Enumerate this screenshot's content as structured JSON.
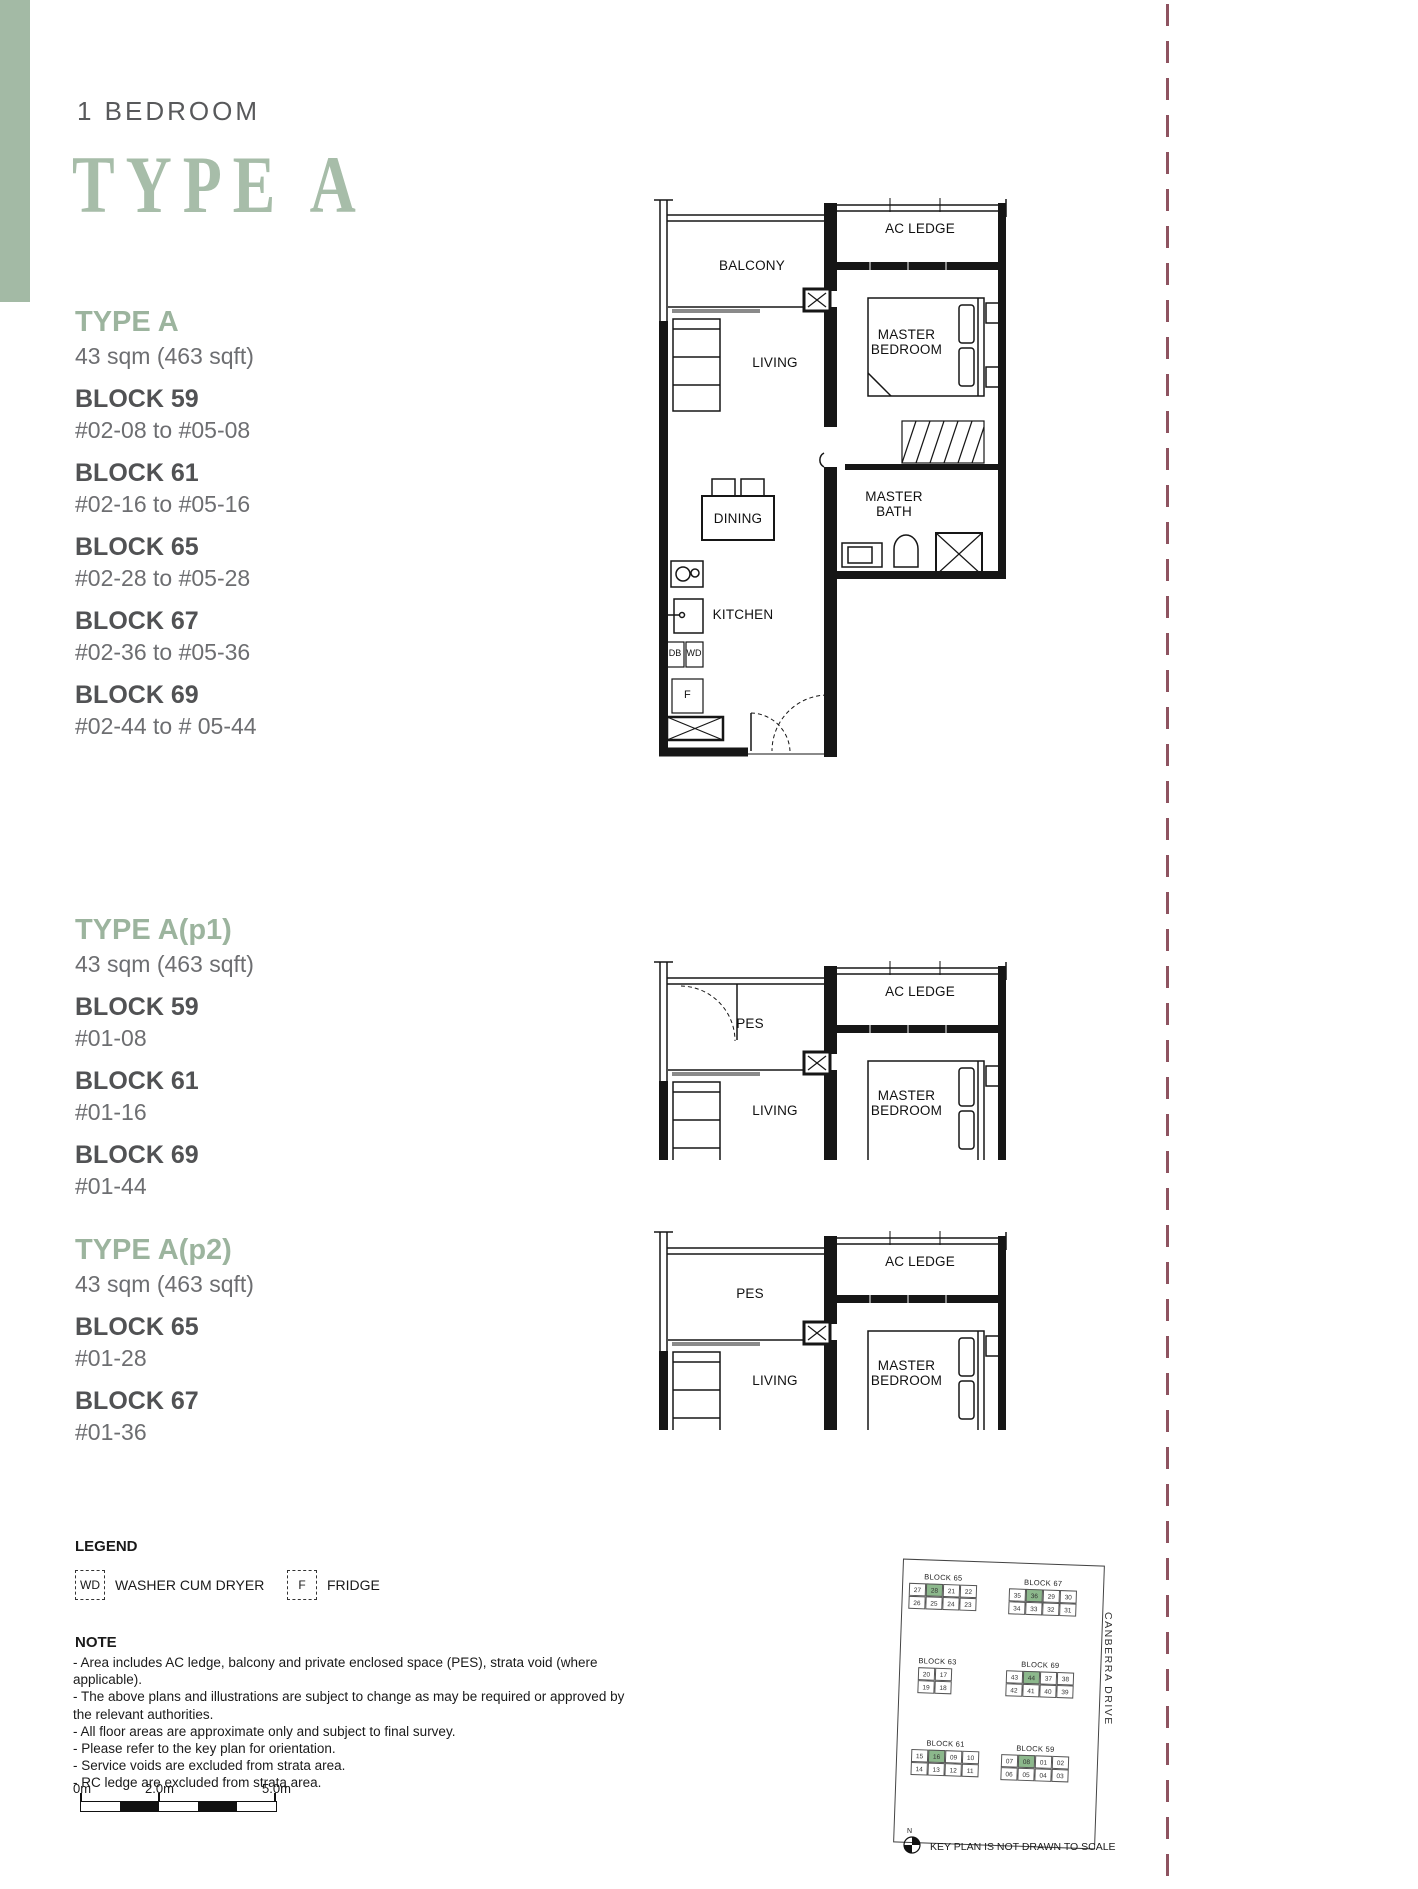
{
  "page": {
    "category": "1 BEDROOM",
    "wordmark": "TYPE A"
  },
  "sections": [
    {
      "title": "TYPE A",
      "area": "43 sqm (463 sqft)",
      "blocks": [
        {
          "name": "BLOCK 59",
          "units": "#02-08 to #05-08"
        },
        {
          "name": "BLOCK 61",
          "units": "#02-16 to #05-16"
        },
        {
          "name": "BLOCK 65",
          "units": "#02-28 to #05-28"
        },
        {
          "name": "BLOCK 67",
          "units": "#02-36 to #05-36"
        },
        {
          "name": "BLOCK 69",
          "units": "#02-44 to # 05-44"
        }
      ]
    },
    {
      "title": "TYPE A(p1)",
      "area": "43 sqm (463 sqft)",
      "blocks": [
        {
          "name": "BLOCK 59",
          "units": "#01-08"
        },
        {
          "name": "BLOCK 61",
          "units": "#01-16"
        },
        {
          "name": "BLOCK 69",
          "units": "#01-44"
        }
      ]
    },
    {
      "title": "TYPE A(p2)",
      "area": "43 sqm (463 sqft)",
      "blocks": [
        {
          "name": "BLOCK 65",
          "units": "#01-28"
        },
        {
          "name": "BLOCK 67",
          "units": "#01-36"
        }
      ]
    }
  ],
  "floorplan_labels": {
    "balcony": "BALCONY",
    "ac_ledge": "AC LEDGE",
    "living": "LIVING",
    "master_bedroom": "MASTER BEDROOM",
    "master_bath": "MASTER BATH",
    "dining": "DINING",
    "kitchen": "KITCHEN",
    "db": "DB",
    "wd": "WD",
    "fridge": "F",
    "pes": "PES"
  },
  "legend": {
    "title": "LEGEND",
    "items": [
      {
        "symbol": "WD",
        "label": "WASHER CUM DRYER"
      },
      {
        "symbol": "F",
        "label": "FRIDGE"
      }
    ]
  },
  "note": {
    "title": "NOTE",
    "items": [
      "- Area includes AC ledge, balcony and private enclosed space (PES), strata void (where applicable).",
      "- The above plans and illustrations are subject to change as may be required or approved by the relevant authorities.",
      "- All floor areas are approximate only and subject to final survey.",
      "- Please refer to the key plan for orientation.",
      "- Service voids are excluded from strata area.",
      "- RC ledge are excluded from strata area."
    ]
  },
  "scalebar": {
    "start": "0m",
    "mid": "2.0m",
    "end": "5.0m"
  },
  "keyplan": {
    "street": "CANBERRA DRIVE",
    "north_label": "N",
    "caption": "KEY PLAN IS NOT DRAWN TO SCALE",
    "blocks": [
      {
        "name": "BLOCK 65",
        "top": [
          "27",
          "28",
          "21",
          "22"
        ],
        "bottom": [
          "26",
          "25",
          "24",
          "23"
        ],
        "highlight": "28"
      },
      {
        "name": "BLOCK 67",
        "top": [
          "35",
          "36",
          "29",
          "30"
        ],
        "bottom": [
          "34",
          "33",
          "32",
          "31"
        ],
        "highlight": "36"
      },
      {
        "name": "BLOCK 63",
        "top": [
          "20",
          "17"
        ],
        "bottom": [
          "19",
          "18"
        ],
        "highlight": ""
      },
      {
        "name": "BLOCK 69",
        "top": [
          "43",
          "44",
          "37",
          "38"
        ],
        "bottom": [
          "42",
          "41",
          "40",
          "39"
        ],
        "highlight": "44"
      },
      {
        "name": "BLOCK 61",
        "top": [
          "15",
          "16",
          "09",
          "10"
        ],
        "bottom": [
          "14",
          "13",
          "12",
          "11"
        ],
        "highlight": "16"
      },
      {
        "name": "BLOCK 59",
        "top": [
          "07",
          "08",
          "01",
          "02"
        ],
        "bottom": [
          "06",
          "05",
          "04",
          "03"
        ],
        "highlight": "08"
      }
    ]
  },
  "colors": {
    "sage": "#a7bda9",
    "sage_bar": "#a3baa5",
    "maroon_dash": "#8e5360",
    "text_dark": "#515254",
    "text_gray": "#6d6e71",
    "highlight_green": "#8cb88c"
  }
}
